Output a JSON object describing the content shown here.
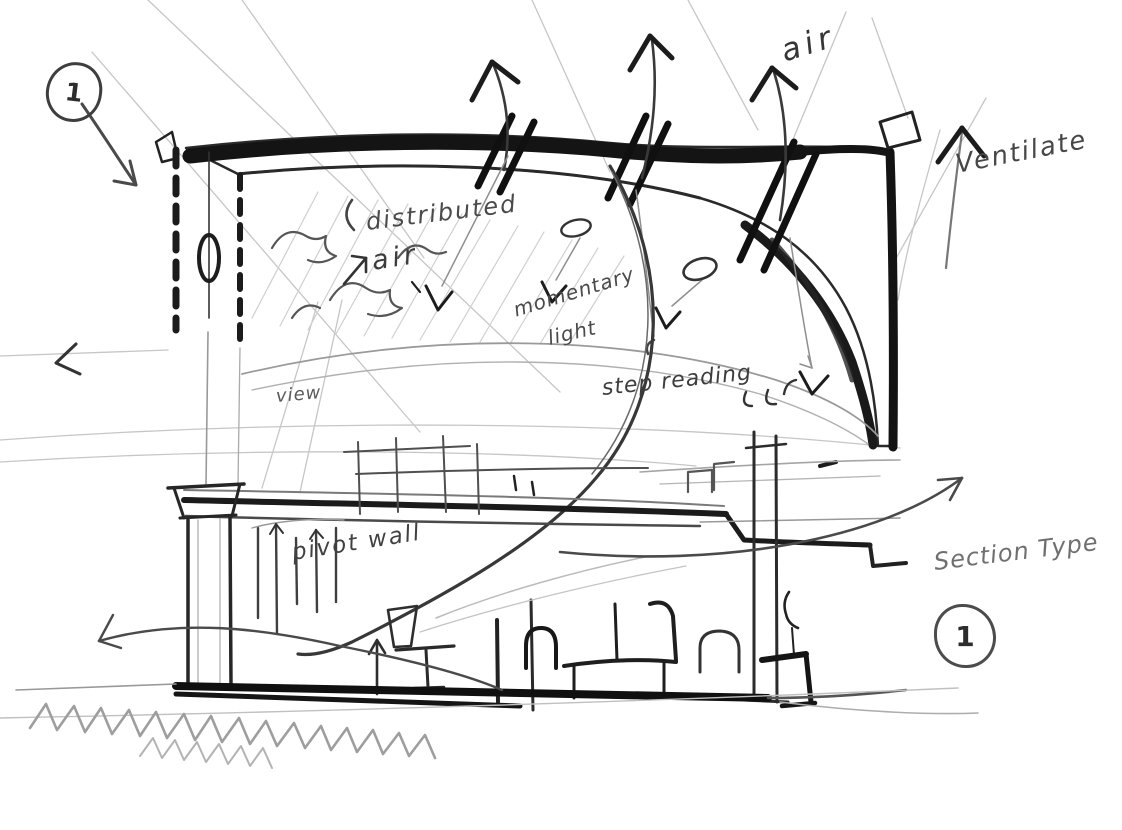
{
  "sketch": {
    "labels": {
      "air": "air",
      "ventilate": "Ventilate",
      "distributed": "distributed",
      "distributed_air": "air",
      "momentary": "momentary",
      "light": "light",
      "view": "view",
      "step_reading": "step reading",
      "pivot_wall": "pivot wall",
      "section_type": "Section Type"
    },
    "markers": {
      "top_left": "1",
      "bottom_right": "1"
    },
    "colors": {
      "paper": "#ffffff",
      "graphite_dark": "#161616",
      "graphite_mid": "#4a4a4a",
      "graphite_light": "#9e9e9e"
    },
    "icons": {
      "up_arrow": "↑",
      "left_arrow": "‹",
      "right_arrow": "→",
      "downlight": "∨"
    }
  }
}
